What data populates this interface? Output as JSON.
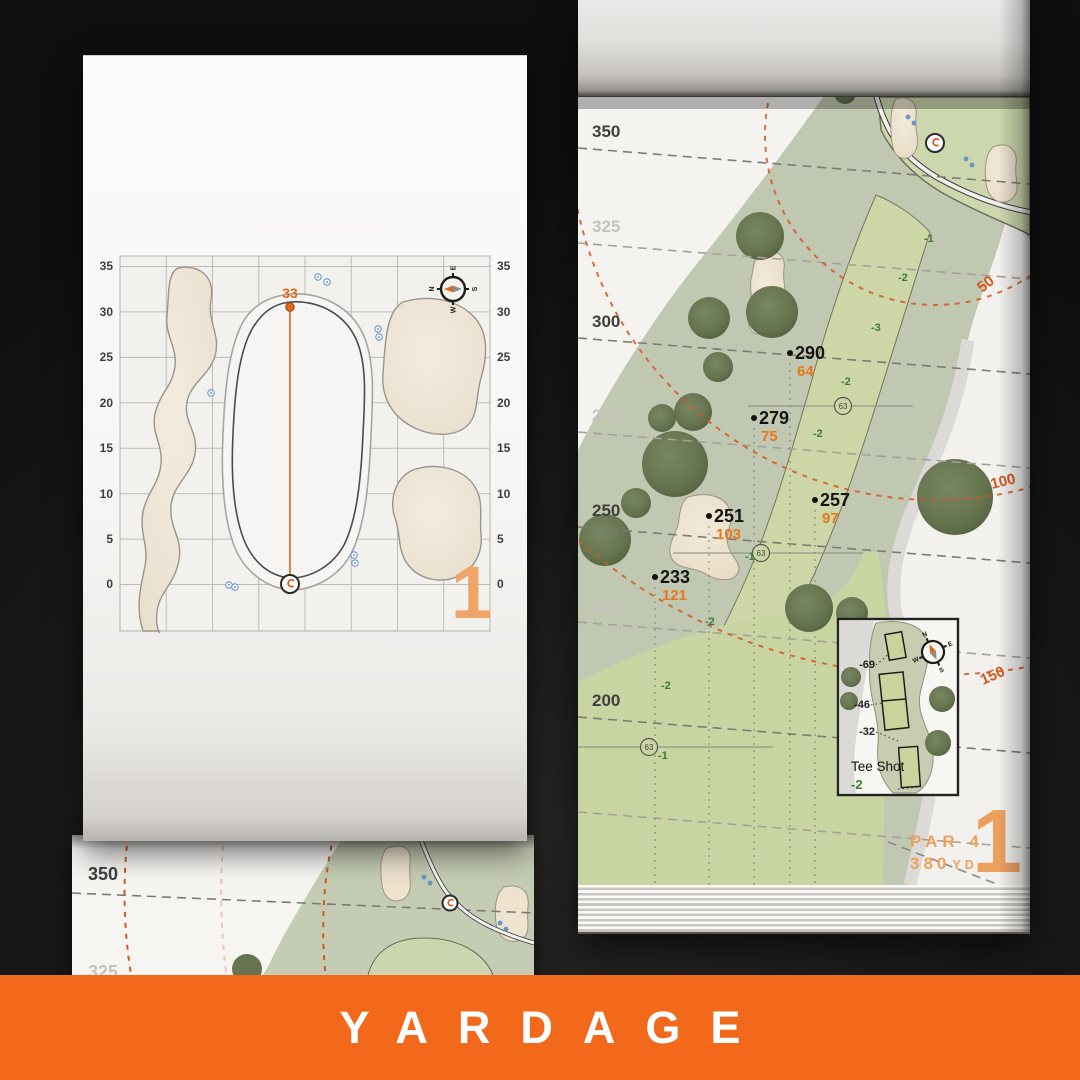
{
  "banner": {
    "label": "YARDAGE",
    "bg_color": "#F2691B",
    "text_color": "#FFFFFF"
  },
  "colors": {
    "accent_orange": "#F2691B",
    "arc_orange": "#D4581F",
    "marker_orange": "#E8761E",
    "slope_green": "#3A7A33",
    "hole_number_orange": "#EDA05E",
    "fairway_green": "#CBD5A5",
    "rough_green": "#C1C8B2",
    "sand": "#EEE3CF"
  },
  "left_page": {
    "hole_number": "1",
    "pin_distance": "33",
    "axis_ticks": [
      "35",
      "30",
      "25",
      "20",
      "15",
      "10",
      "5",
      "0"
    ],
    "compass": {
      "n": "N",
      "e": "E",
      "s": "S",
      "w": "W"
    }
  },
  "lower_page": {
    "yardage_labels": [
      "350",
      "325"
    ]
  },
  "right_page": {
    "hole_number": "1",
    "par_label": "PAR 4",
    "distance": "380",
    "distance_unit": "YD",
    "yardage_lines": [
      "350",
      "325",
      "300",
      "275",
      "250",
      "225",
      "200"
    ],
    "arc_labels": [
      "50",
      "100",
      "150"
    ],
    "markers": [
      {
        "carry": "290",
        "remaining": "64"
      },
      {
        "carry": "279",
        "remaining": "75"
      },
      {
        "carry": "257",
        "remaining": "97"
      },
      {
        "carry": "251",
        "remaining": "103"
      },
      {
        "carry": "233",
        "remaining": "121"
      }
    ],
    "sprinkler_label": "63",
    "slope_numbers": [
      "-1",
      "-2",
      "-3",
      "-2",
      "-2",
      "-1",
      "-2",
      "-2",
      "-1"
    ],
    "tee_inset": {
      "title": "Tee Shot",
      "slope": "-2",
      "offsets": [
        "-69",
        "-46",
        "-32"
      ]
    },
    "compass": {
      "n": "N",
      "e": "E",
      "s": "S",
      "w": "W"
    }
  }
}
